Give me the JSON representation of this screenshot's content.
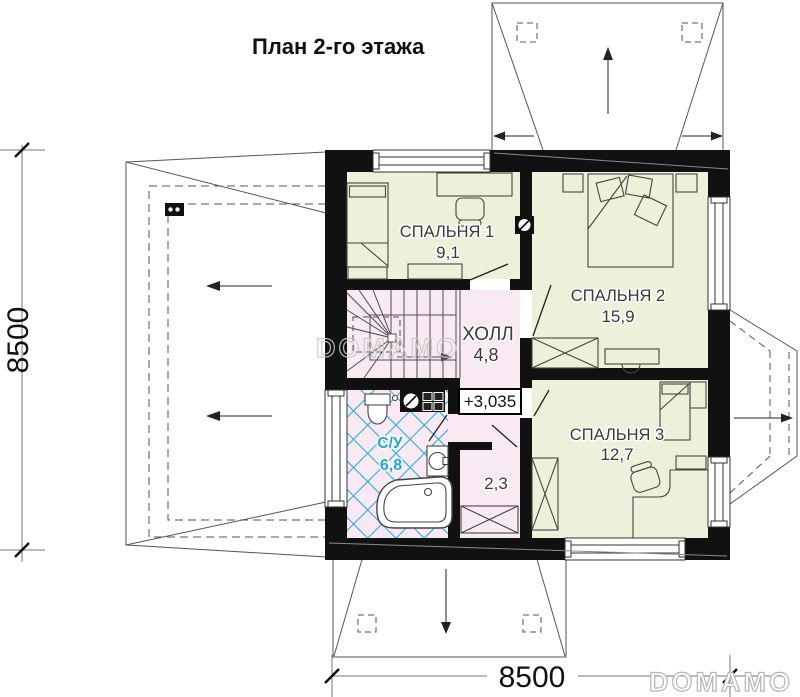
{
  "title": "План 2-го этажа",
  "floor_plan": {
    "rooms": [
      {
        "id": "bedroom-1",
        "name": "СПАЛЬНЯ 1",
        "area": "9,1"
      },
      {
        "id": "bedroom-2",
        "name": "СПАЛЬНЯ 2",
        "area": "15,9"
      },
      {
        "id": "bedroom-3",
        "name": "СПАЛЬНЯ 3",
        "area": "12,7"
      },
      {
        "id": "hall",
        "name": "ХОЛЛ",
        "area": "4,8"
      },
      {
        "id": "bathroom",
        "name": "С/У",
        "area": "6,8"
      },
      {
        "id": "storage",
        "name": "",
        "area": "2,3"
      }
    ],
    "elevation_mark": "+3,035"
  },
  "dimensions": {
    "left": "8500",
    "bottom": "8500"
  },
  "watermark_text": "DOMAMO",
  "logo_text": "DOMAMO",
  "colors": {
    "wall": "#111111",
    "room_fill": "#eef1d9",
    "hall_fill": "#f9e9f3",
    "tile_blue": "#29b0e3",
    "bath_label": "#1fa5d9"
  }
}
